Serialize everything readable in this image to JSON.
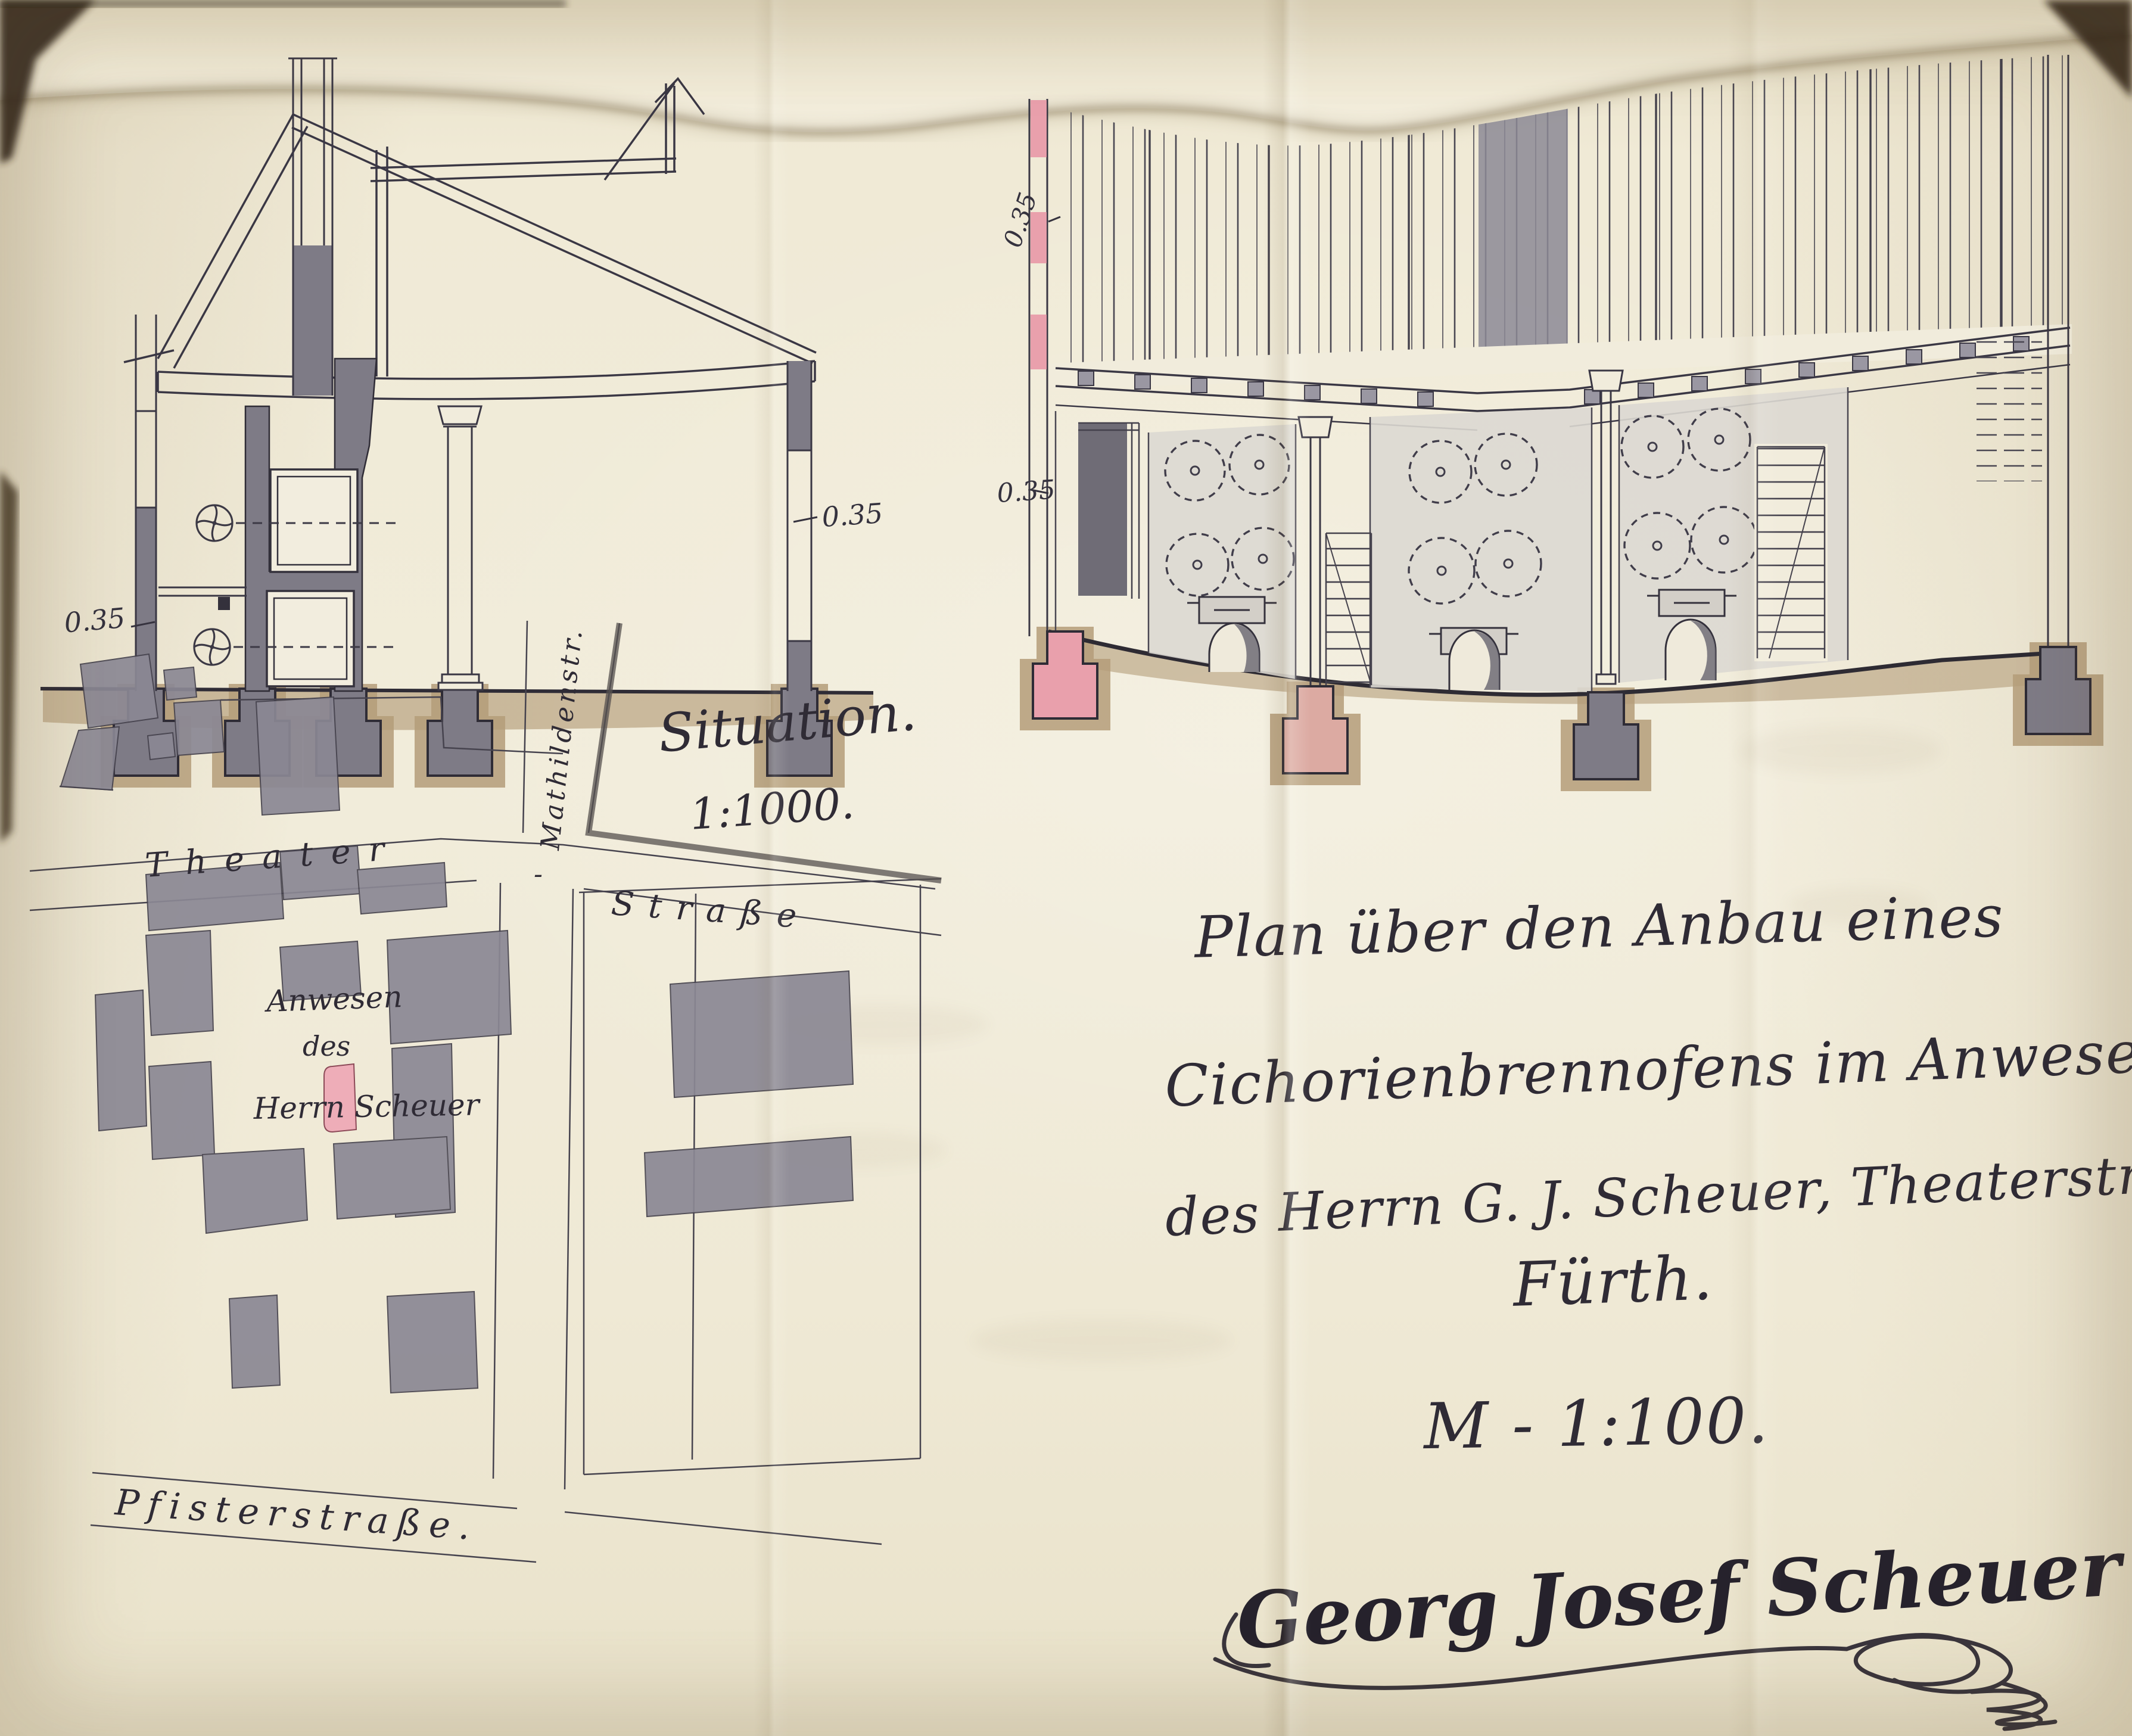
{
  "drawings": {
    "cross_section": {
      "dim_labels": [
        "0.35",
        "0.35"
      ]
    },
    "long_section": {
      "dim_labels": [
        "0.35",
        "0.35"
      ]
    }
  },
  "site_plan": {
    "title": "Situation.",
    "scale": "1:1000.",
    "streets": {
      "theater": "Theater",
      "theater_sep": "-",
      "strasse": "Straße",
      "mathilden": "Mathildenstr.",
      "pfister": "Pfisterstraße."
    },
    "property": {
      "line1": "Anwesen",
      "line2": "des",
      "line3": "Herrn Scheuer"
    }
  },
  "title_block": {
    "lines": [
      "Plan über den Anbau eines",
      "Cichorienbrennofens im Anwesen",
      "des Herrn G. J. Scheuer, Theaterstr., 37",
      "Fürth."
    ],
    "scale": "M - 1:100."
  },
  "signature": {
    "name": "Georg Josef Scheuer"
  },
  "colors": {
    "paper": "#efe9d5",
    "ink": "#35323e",
    "wall_gray": "#7e7b86",
    "panel_gray": "#dcd8d1",
    "foundation_tan": "#b49c79",
    "highlight_pink": "#e9a0ac",
    "plan_pink": "#eeadb8"
  }
}
